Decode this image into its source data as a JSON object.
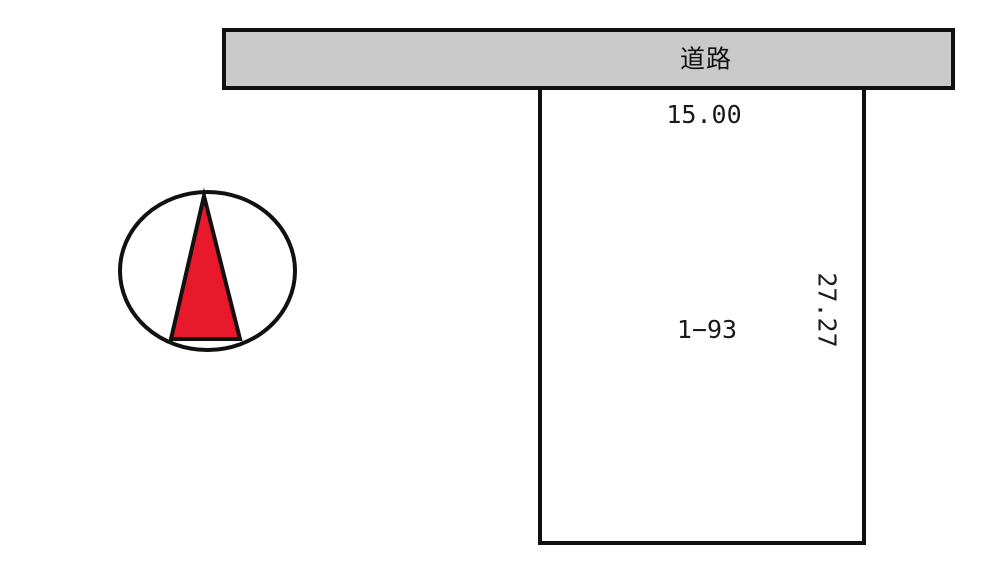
{
  "road": {
    "label": "道路"
  },
  "parcel": {
    "lot_number": "1−93",
    "frontage": "15.00",
    "depth": "27.27"
  },
  "icons": {
    "north_arrow": "north-arrow-icon"
  },
  "colors": {
    "background": "#ffffff",
    "line": "#111111",
    "road_fill": "#c9c9c9",
    "north_arrow_red": "#e8192b",
    "text": "#1a1a1a"
  }
}
